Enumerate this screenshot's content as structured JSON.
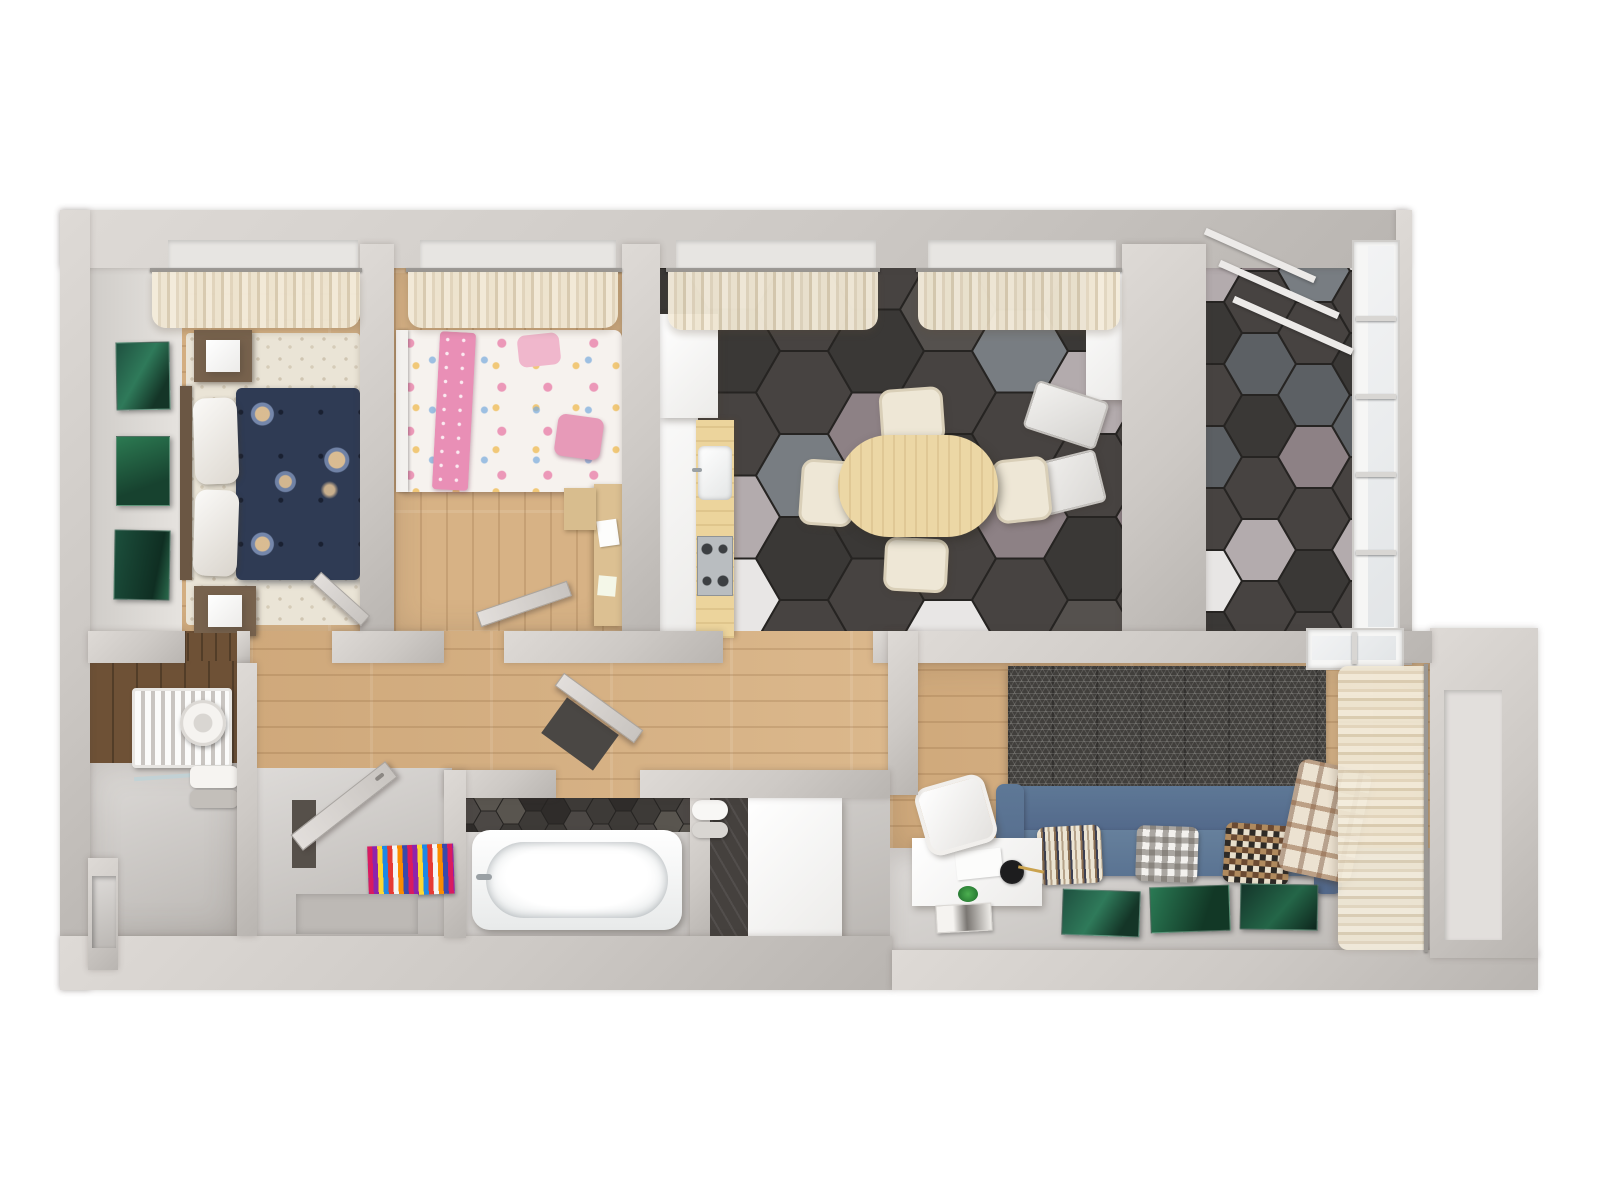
{
  "meta": {
    "scene_type": "3d-apartment-floor-plan-render",
    "view": "top-down",
    "rooms": [
      "master-bedroom",
      "kids-bedroom",
      "kitchen-dining",
      "balcony",
      "utility-room",
      "bathroom",
      "entrance-hall",
      "living-room"
    ],
    "counts": {
      "dining_chairs": 4,
      "sofa_pillows": 3,
      "master_wall_artworks": 3,
      "living_floor_artworks": 3,
      "folded_chairs": 2,
      "curtain_windows_top": 4
    }
  },
  "palette": {
    "background": "#ffffff",
    "wall": "#cdc9c5",
    "wall_dark": "#b9b5b1",
    "wall_light": "#dedad6",
    "wood": "#d7b285",
    "wood_dark2": "#6e5136",
    "floor_gray": "#cbc7c3",
    "rug_cream": "#eae4d6",
    "sofa_blue": "#5e7896",
    "curtain": "#efe6d2",
    "art_green": "#1f5140",
    "bed_navy": "#2f3b54",
    "bed_pink": "#e98fb6",
    "table_wood": "#ecd7a5",
    "chair_cream": "#eee7d6",
    "tub_white": "#f7f9f9",
    "rug_multicolor": [
      "#d81b60",
      "#8e24aa",
      "#fdd835",
      "#1e88e5",
      "#e53935",
      "#f5f5f5",
      "#fb8c00",
      "#3949ab"
    ]
  },
  "hex_floors": {
    "kitchen": {
      "tile_w": 96,
      "colors": [
        "#474341",
        "#3a3836",
        "#5c6064",
        "#787d82",
        "#b3abad",
        "#8d8185",
        "#e8e6e5",
        "#55514e"
      ],
      "pattern": [
        0,
        1,
        2,
        0,
        7,
        1,
        0,
        2,
        1,
        0,
        4,
        6,
        0,
        1,
        2,
        0,
        0,
        3,
        1,
        0,
        6,
        0,
        1,
        5,
        1,
        0,
        2,
        4,
        0,
        7,
        0,
        1,
        0,
        6,
        1,
        0,
        3,
        0,
        5,
        0,
        2,
        0,
        0,
        1,
        4,
        0,
        1,
        7,
        0,
        2,
        1,
        0,
        5,
        0,
        6,
        0
      ]
    },
    "balcony": {
      "tile_w": 72,
      "colors": [
        "#474341",
        "#3a3836",
        "#5c6064",
        "#787d82",
        "#b3abad",
        "#8d8185",
        "#e8e6e5",
        "#55514e"
      ],
      "pattern": [
        0,
        4,
        1,
        0,
        2,
        0,
        6,
        1,
        0,
        5,
        0,
        2,
        1,
        0,
        4,
        0,
        6,
        1,
        0,
        3,
        0,
        2,
        5,
        0,
        1,
        0,
        0,
        6,
        0,
        1,
        2,
        0,
        4,
        0,
        1,
        0
      ]
    },
    "bath_wall": {
      "tile_w": 30,
      "colors": [
        "#3d3a37",
        "#4c4845",
        "#2f2c2a",
        "#59554f",
        "#e9e7e4"
      ],
      "pattern": [
        0,
        1,
        2,
        0,
        3,
        1,
        0,
        2,
        1,
        3,
        0,
        1,
        2,
        0,
        4,
        0,
        1,
        2,
        0,
        3,
        0,
        1,
        0,
        2,
        3,
        0,
        1,
        0,
        2,
        0,
        1,
        3,
        0
      ]
    }
  }
}
